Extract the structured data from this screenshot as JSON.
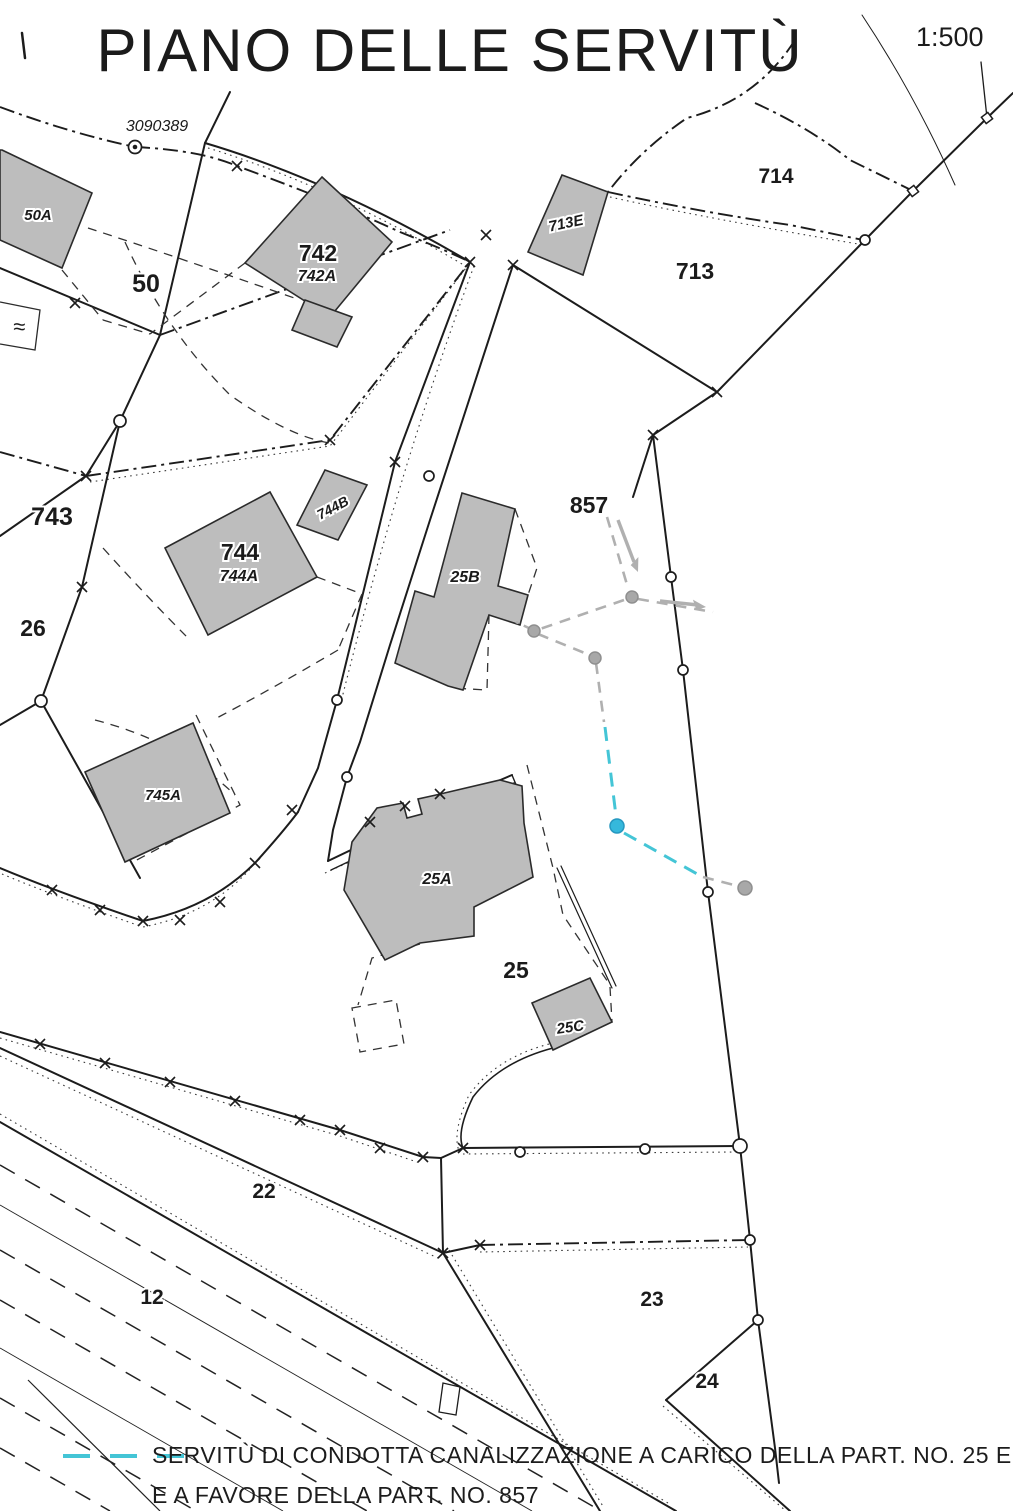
{
  "title": "PIANO DELLE SERVITÙ",
  "scale_label": "1:500",
  "survey_point": {
    "id": "3090389",
    "x": 157,
    "y": 131
  },
  "legend": {
    "symbol": "cyan-dashed-servitude-line",
    "line1": "SERVITÙ DI CONDOTTA CANALIZZAZIONE  A CARICO DELLA PART. NO. 25 E",
    "line2": "E A FAVORE DELLA PART. NO. 857"
  },
  "colors": {
    "line": "#1c1c1c",
    "building_fill": "#bdbdbd",
    "building_stroke": "#2b2b2b",
    "servitude_cyan": "#44c5d6",
    "servitude_node_blue": "#35b8dc",
    "servitude_gray": "#b0b0b0"
  },
  "parcel_labels": [
    {
      "text": "50",
      "x": 146,
      "y": 292,
      "size": 25
    },
    {
      "text": "742",
      "x": 318,
      "y": 261,
      "size": 23
    },
    {
      "text": "713",
      "x": 695,
      "y": 279,
      "size": 23
    },
    {
      "text": "714",
      "x": 776,
      "y": 183,
      "size": 21
    },
    {
      "text": "743",
      "x": 52,
      "y": 525,
      "size": 25
    },
    {
      "text": "744",
      "x": 240,
      "y": 560,
      "size": 23
    },
    {
      "text": "26",
      "x": 33,
      "y": 636,
      "size": 23
    },
    {
      "text": "857",
      "x": 589,
      "y": 513,
      "size": 23
    },
    {
      "text": "25",
      "x": 516,
      "y": 978,
      "size": 23
    },
    {
      "text": "22",
      "x": 264,
      "y": 1198,
      "size": 21
    },
    {
      "text": "12",
      "x": 152,
      "y": 1304,
      "size": 21
    },
    {
      "text": "23",
      "x": 652,
      "y": 1306,
      "size": 21
    },
    {
      "text": "24",
      "x": 707,
      "y": 1388,
      "size": 21
    }
  ],
  "building_labels": [
    {
      "text": "50A",
      "x": 38,
      "y": 220,
      "size": 15,
      "rot": 0
    },
    {
      "text": "742A",
      "x": 317,
      "y": 281,
      "size": 16,
      "rot": 0
    },
    {
      "text": "713E",
      "x": 567,
      "y": 228,
      "size": 15,
      "rot": -12
    },
    {
      "text": "744A",
      "x": 239,
      "y": 581,
      "size": 16,
      "rot": 0
    },
    {
      "text": "744B",
      "x": 335,
      "y": 512,
      "size": 14,
      "rot": -28
    },
    {
      "text": "25B",
      "x": 465,
      "y": 582,
      "size": 16,
      "rot": 0
    },
    {
      "text": "745A",
      "x": 163,
      "y": 800,
      "size": 15,
      "rot": 0
    },
    {
      "text": "25A",
      "x": 437,
      "y": 884,
      "size": 16,
      "rot": 0
    },
    {
      "text": "25C",
      "x": 571,
      "y": 1032,
      "size": 15,
      "rot": -8
    }
  ],
  "water_symbol": {
    "glyph": "≈",
    "x": 13,
    "y": 334
  }
}
